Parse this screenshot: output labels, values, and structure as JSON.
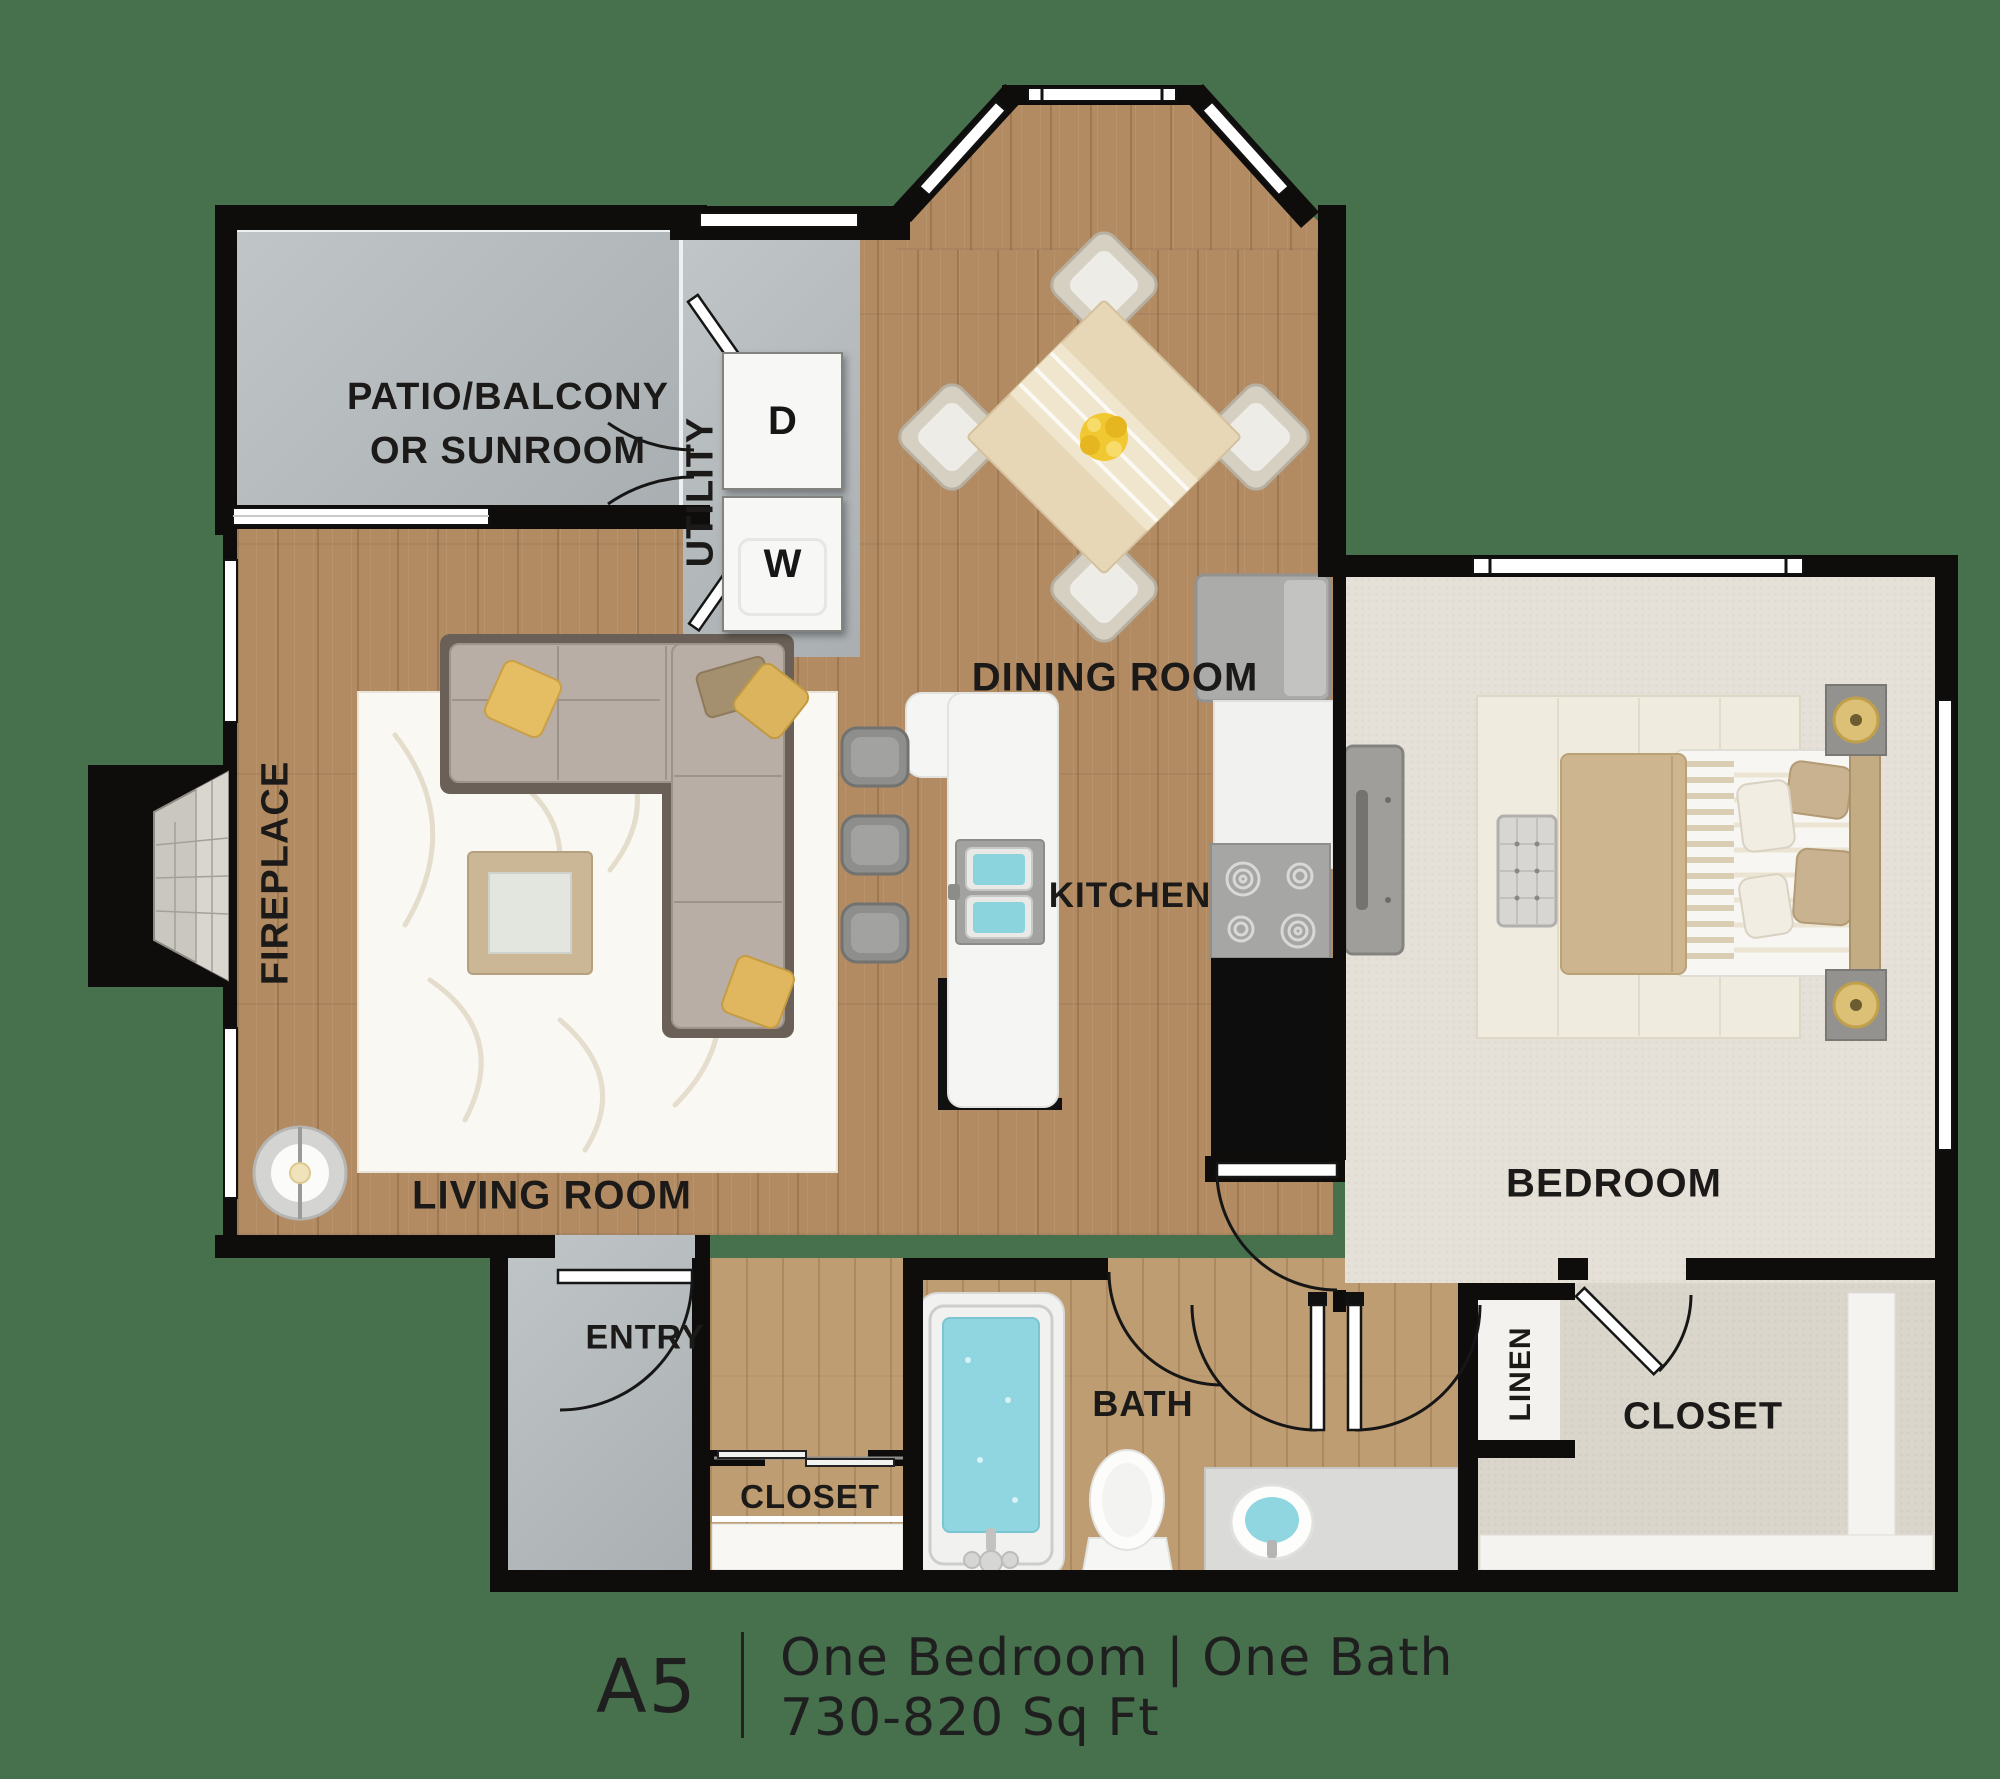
{
  "title": "Apartment floor plan A5",
  "floor_plan": {
    "rooms": {
      "patio": {
        "label_line1": "PATIO/BALCONY",
        "label_line2": "OR SUNROOM"
      },
      "utility": {
        "label": "UTILITY",
        "appliances": [
          {
            "label": "D"
          },
          {
            "label": "W"
          }
        ]
      },
      "dining": {
        "label": "DINING ROOM"
      },
      "living": {
        "label": "LIVING ROOM"
      },
      "fireplace": {
        "label": "FIREPLACE"
      },
      "kitchen": {
        "label": "KITCHEN"
      },
      "bedroom": {
        "label": "BEDROOM"
      },
      "entry": {
        "label": "ENTRY"
      },
      "bath": {
        "label": "BATH"
      },
      "entry_closet": {
        "label": "CLOSET"
      },
      "linen": {
        "label": "LINEN"
      },
      "bedroom_closet": {
        "label": "CLOSET"
      }
    },
    "colors": {
      "background": "#47704d",
      "walls": "#0e0d0b",
      "wood_floor": "#b28b63",
      "wood_floor_light": "#bf9d72",
      "gray_floor": "#b6bcbf",
      "carpet": "#e6e1d8",
      "closet_carpet": "#dbd6cb",
      "water": "#8fd6e0",
      "accent_pillow": "#e5bd62",
      "label_text": "#1b1a18"
    }
  },
  "footer": {
    "plan_code": "A5",
    "details": "One Bedroom | One Bath",
    "area": "730-820 Sq Ft"
  }
}
